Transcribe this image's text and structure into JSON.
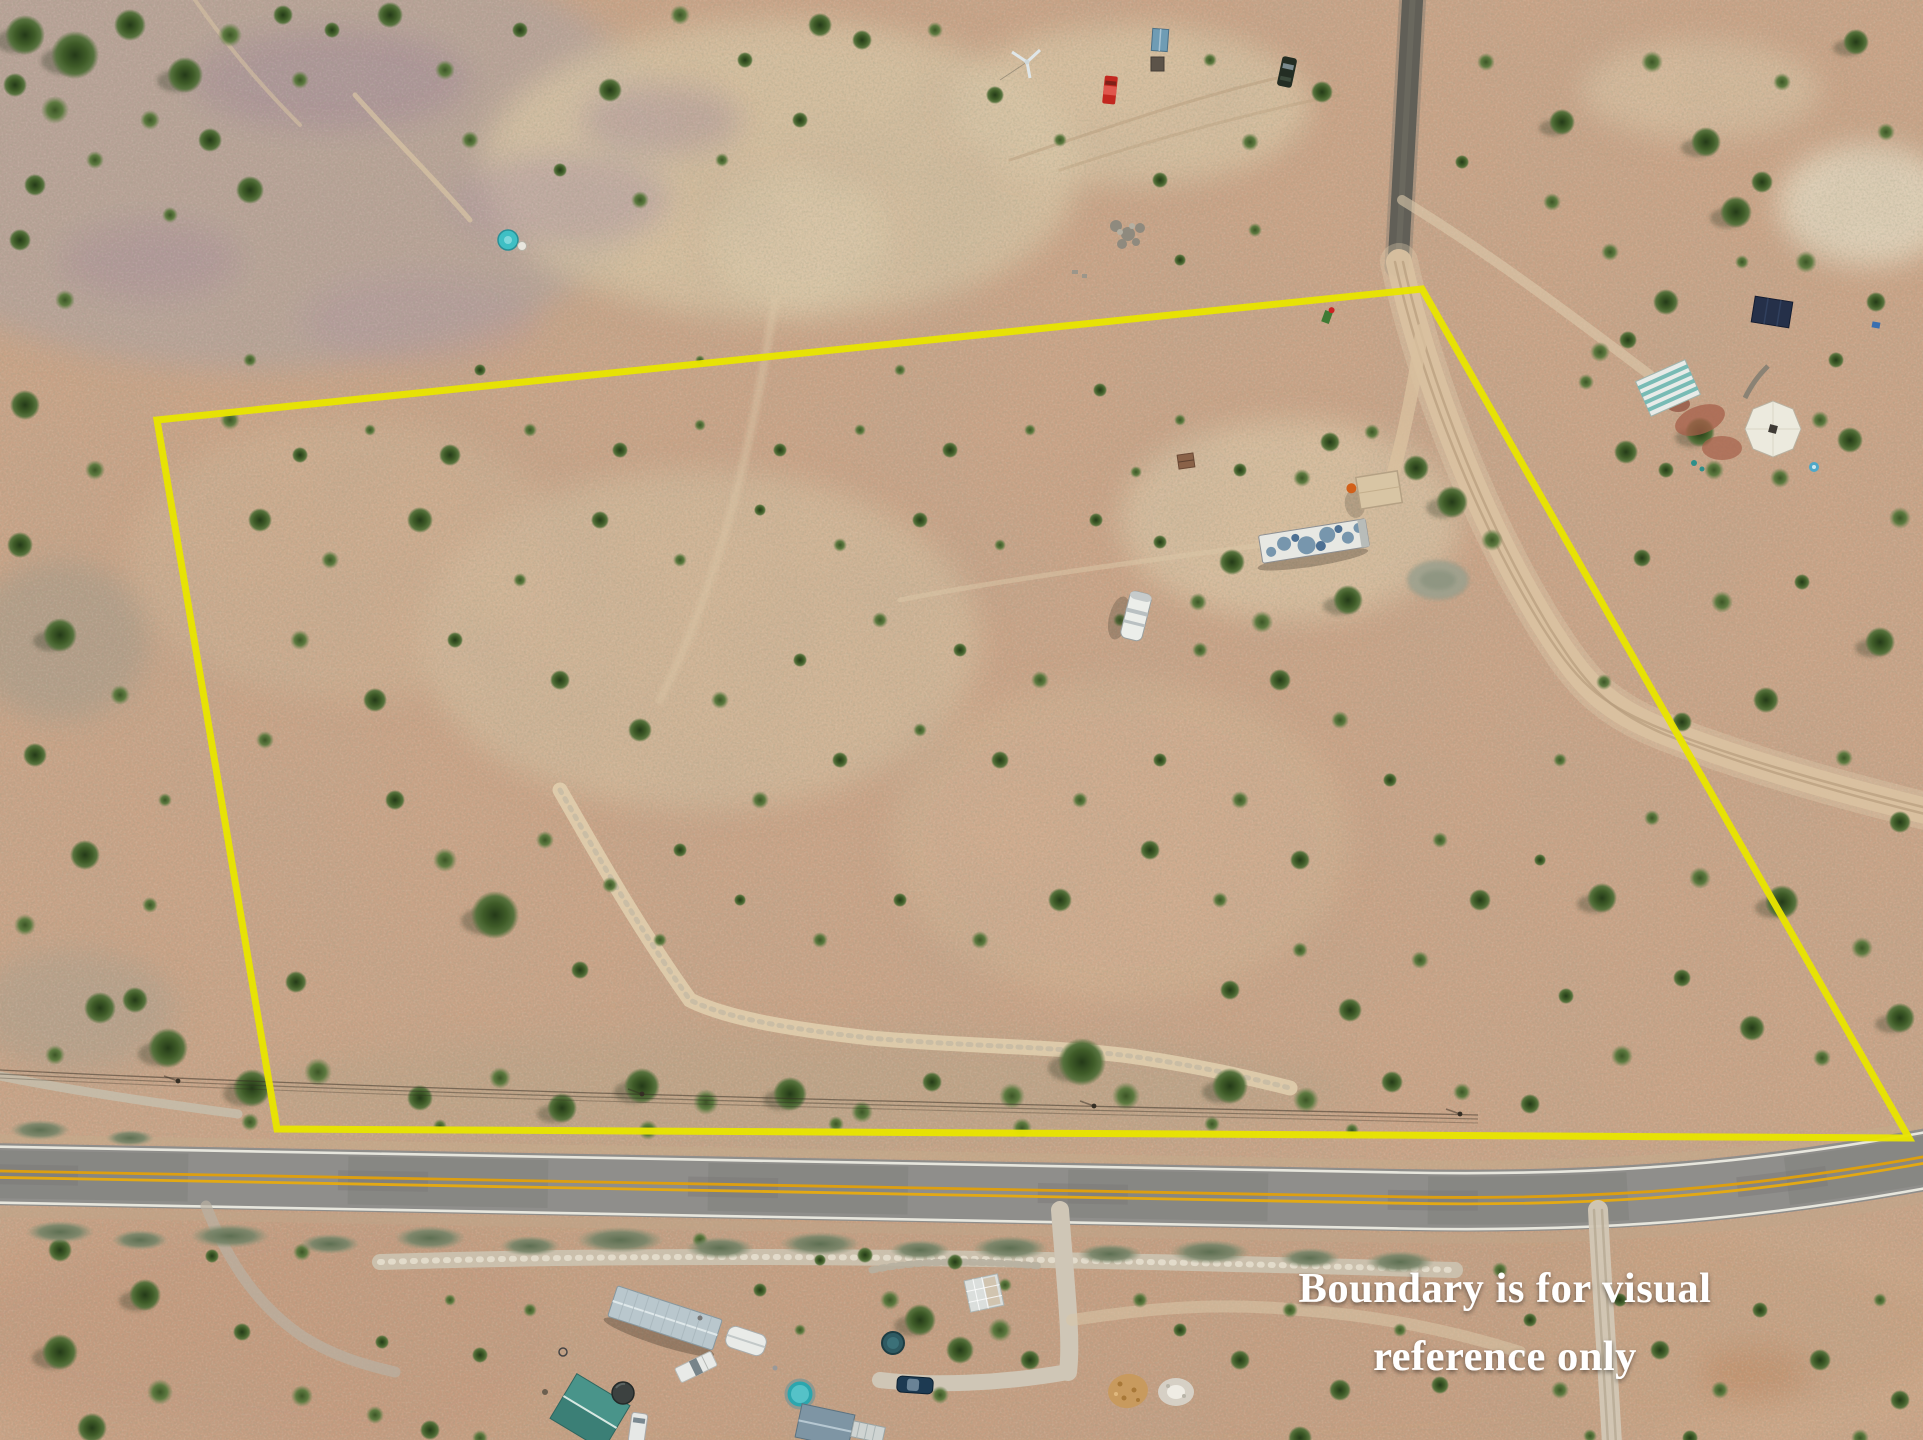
{
  "image": {
    "kind": "aerial drone photograph",
    "setting": "high-desert scrubland parcel dotted with juniper shrubs"
  },
  "overlay": {
    "disclaimer": {
      "line1": "Boundary is for visual",
      "line2": "reference only"
    },
    "text_color": "#ffffff",
    "boundary": {
      "color": "#e8e400",
      "points": "157,420 1422,289 1909,1138 277,1129"
    }
  },
  "palette": {
    "sand": "#c9a387",
    "sand_light": "#dcc7a7",
    "sand_pink": "#cfa68b",
    "lilac_gray": "#b2a29c",
    "shrub_dark": "#3d5a2c",
    "shrub_mid": "#5a7a3c",
    "asphalt": "#8f8e8b",
    "road_yellow": "#e3a914",
    "road_white": "#ecebe2",
    "dirt_road": "#d9c1a0",
    "gravel_road": "#615f57"
  },
  "features": {
    "boundary_line": "yellow parcel boundary overlay",
    "paved_road": "two-lane paved road with double yellow centerline and white edge lines",
    "gravel_road": "dark gravel road entering from top right",
    "east_dirt_road": "dirt road along the east boundary",
    "driveways": "dirt driveways branching south of the paved road",
    "wash": "sandy arroyo crossing the parcel",
    "trailer_home": "single-wide trailer with mottled white-blue roof",
    "rv_trailer": "white RV trailer",
    "carport": "tan carport canopy with orange tractor",
    "pond": "small gray-green stock pond",
    "water_tank": "turquoise water tank (upper left)",
    "north_vehicles": "red pickup and dark SUV parked near sheds (top)",
    "ne_homestead": "neighboring homestead with white octagonal roof, teal striped building and solar panel",
    "sw_homestead": "neighboring homestead with metal-roofed mobile home, sheds, pickup and pool",
    "s_homestead": "homestead south of road with greenhouse, dark blue car and round pool",
    "power_line": "utility lines along the north side of the road"
  }
}
